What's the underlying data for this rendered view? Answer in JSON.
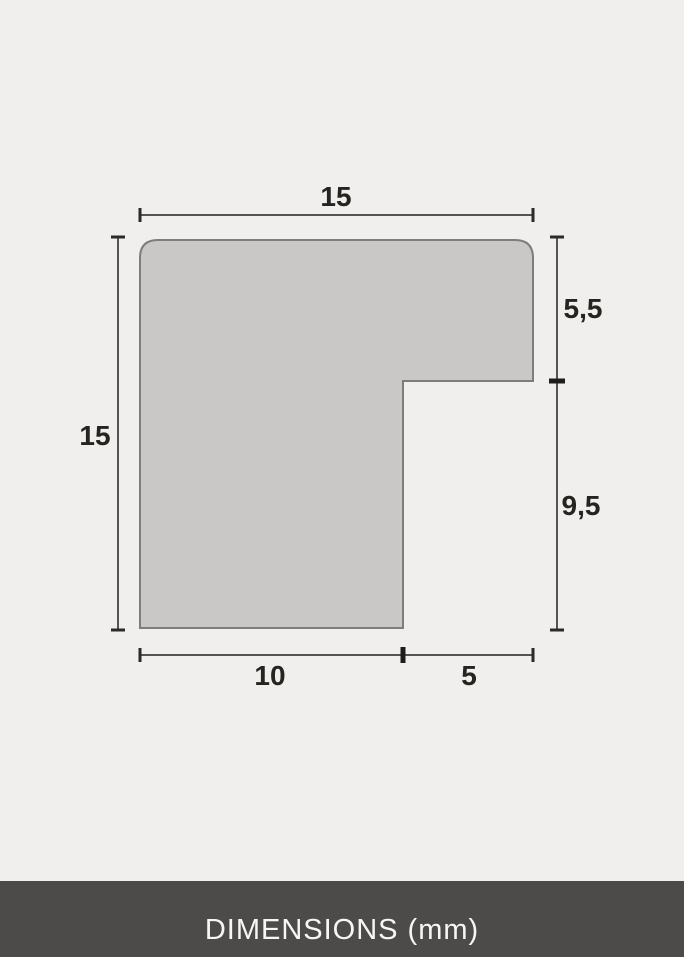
{
  "page": {
    "background_color": "#f0efee"
  },
  "diagram": {
    "subject": "frame-moulding-profile-cross-section",
    "unit": "mm",
    "shape": {
      "fill_color": "#c9c8c6",
      "stroke_color": "#7e7d7b",
      "outline": "L-shaped profile, rounded top corners"
    },
    "dimension_line_color": "#55544f",
    "labels": {
      "top_width": "15",
      "left_height": "15",
      "right_upper": "5,5",
      "right_lower": "9,5",
      "bottom_left": "10",
      "bottom_right": "5"
    }
  },
  "footer": {
    "title": "DIMENSIONS (mm)",
    "background_color": "#4c4b49",
    "text_color": "#f7f6f4"
  }
}
